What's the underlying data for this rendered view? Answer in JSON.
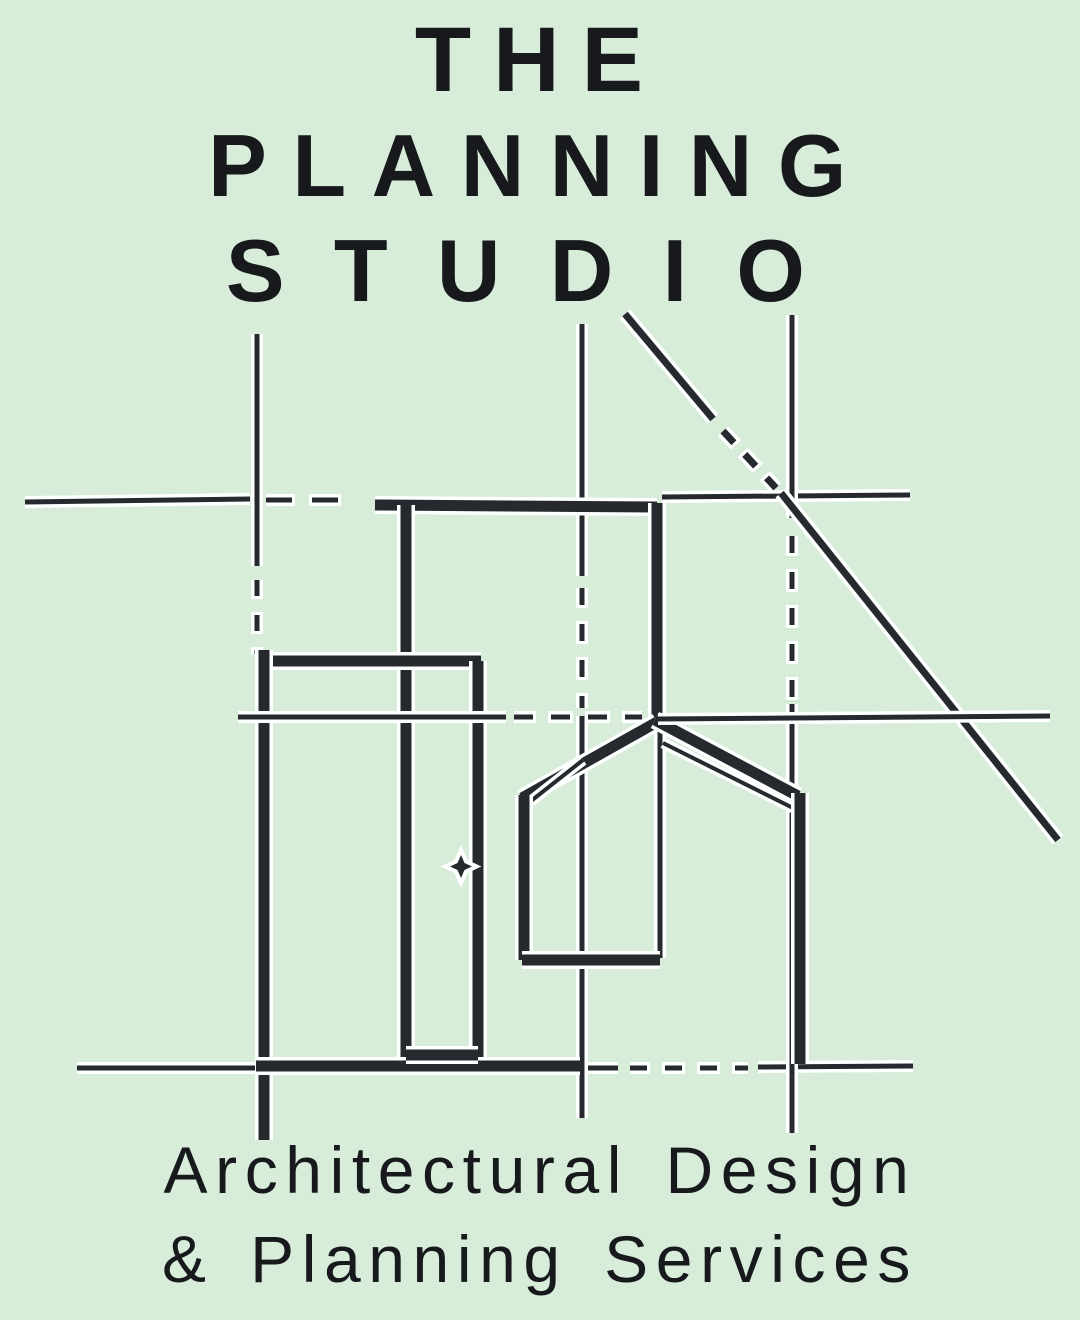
{
  "background_color": "#d7ecd9",
  "ink_color": "#17191c",
  "stroke_color": "#26292e",
  "halo_color": "#feffff",
  "title": {
    "line1": "THE",
    "line2": "PLANNING",
    "line3": "STUDIO"
  },
  "subtitle": {
    "line1": "Architectural Design",
    "line2": "& Planning Services"
  },
  "logo_drawing": {
    "description": "blueprint-style architectural sketch: construction lines, door frame, door with knob, two gabled building outlines, diagonal roof line",
    "strokes": [
      {
        "id": "construction-h-upper-left",
        "x1": 25,
        "y1": 502,
        "x2": 250,
        "y2": 499,
        "w": 5
      },
      {
        "id": "construction-h-upper-dashes",
        "x1": 266,
        "y1": 500,
        "x2": 354,
        "y2": 500,
        "w": 5,
        "dash": "26 20"
      },
      {
        "id": "construction-h-upper-right",
        "x1": 662,
        "y1": 497,
        "x2": 910,
        "y2": 495,
        "w": 5
      },
      {
        "id": "construction-h-lower-left",
        "x1": 77,
        "y1": 1068,
        "x2": 618,
        "y2": 1068,
        "w": 5
      },
      {
        "id": "construction-h-lower-dashes",
        "x1": 630,
        "y1": 1068,
        "x2": 748,
        "y2": 1068,
        "w": 5,
        "dash": "17 18"
      },
      {
        "id": "construction-h-lower-right",
        "x1": 758,
        "y1": 1067,
        "x2": 913,
        "y2": 1066,
        "w": 5
      },
      {
        "id": "construction-v1-top",
        "x1": 257,
        "y1": 334,
        "x2": 257,
        "y2": 566,
        "w": 5
      },
      {
        "id": "construction-v1-dashes",
        "x1": 257,
        "y1": 580,
        "x2": 257,
        "y2": 654,
        "w": 5,
        "dash": "16 19"
      },
      {
        "id": "construction-v2-top",
        "x1": 582,
        "y1": 324,
        "x2": 582,
        "y2": 576,
        "w": 5
      },
      {
        "id": "construction-v2-dashes",
        "x1": 582,
        "y1": 588,
        "x2": 582,
        "y2": 708,
        "w": 5,
        "dash": "17 19"
      },
      {
        "id": "construction-v2-bottom",
        "x1": 582,
        "y1": 716,
        "x2": 582,
        "y2": 1118,
        "w": 5
      },
      {
        "id": "construction-v3-top",
        "x1": 792,
        "y1": 315,
        "x2": 792,
        "y2": 518,
        "w": 5
      },
      {
        "id": "construction-v3-dashes",
        "x1": 792,
        "y1": 536,
        "x2": 792,
        "y2": 700,
        "w": 5,
        "dash": "17 19"
      },
      {
        "id": "construction-v3-bottom",
        "x1": 792,
        "y1": 704,
        "x2": 792,
        "y2": 1133,
        "w": 5
      },
      {
        "id": "roof-diagonal-top",
        "x1": 625,
        "y1": 314,
        "x2": 713,
        "y2": 419,
        "w": 7
      },
      {
        "id": "roof-diagonal-dashes",
        "x1": 723,
        "y1": 431,
        "x2": 776,
        "y2": 488,
        "w": 7,
        "dash": "16 16"
      },
      {
        "id": "roof-diagonal-bottom",
        "x1": 781,
        "y1": 493,
        "x2": 1058,
        "y2": 840,
        "w": 7
      },
      {
        "id": "frame-top",
        "x1": 375,
        "y1": 505,
        "x2": 657,
        "y2": 507,
        "w": 11
      },
      {
        "id": "frame-left",
        "x1": 406,
        "y1": 505,
        "x2": 406,
        "y2": 1060,
        "w": 11
      },
      {
        "id": "frame-right-upper",
        "x1": 657,
        "y1": 503,
        "x2": 657,
        "y2": 724,
        "w": 11
      },
      {
        "id": "frame-right-lower",
        "x1": 660,
        "y1": 724,
        "x2": 660,
        "y2": 958,
        "w": 5
      },
      {
        "id": "door-top",
        "x1": 258,
        "y1": 661,
        "x2": 481,
        "y2": 661,
        "w": 11
      },
      {
        "id": "door-left",
        "x1": 264,
        "y1": 650,
        "x2": 264,
        "y2": 1140,
        "w": 11
      },
      {
        "id": "door-right",
        "x1": 478,
        "y1": 661,
        "x2": 478,
        "y2": 1060,
        "w": 11
      },
      {
        "id": "door-bottom",
        "x1": 256,
        "y1": 1066,
        "x2": 580,
        "y2": 1066,
        "w": 11
      },
      {
        "id": "door-panel-bottom",
        "x1": 406,
        "y1": 1055,
        "x2": 478,
        "y2": 1055,
        "w": 11
      },
      {
        "id": "gable-left-roof",
        "x1": 657,
        "y1": 722,
        "x2": 522,
        "y2": 798,
        "w": 11
      },
      {
        "id": "gable-left-roof-echo",
        "x1": 583,
        "y1": 760,
        "x2": 531,
        "y2": 801,
        "w": 4
      },
      {
        "id": "gable-left-wall",
        "x1": 524,
        "y1": 795,
        "x2": 524,
        "y2": 960,
        "w": 11
      },
      {
        "id": "gable-left-bottom",
        "x1": 522,
        "y1": 960,
        "x2": 660,
        "y2": 960,
        "w": 11
      },
      {
        "id": "gable-right-roof",
        "x1": 655,
        "y1": 720,
        "x2": 798,
        "y2": 796,
        "w": 11
      },
      {
        "id": "gable-right-roof-echo",
        "x1": 663,
        "y1": 743,
        "x2": 793,
        "y2": 808,
        "w": 4
      },
      {
        "id": "gable-right-wall",
        "x1": 800,
        "y1": 793,
        "x2": 800,
        "y2": 1064,
        "w": 11
      },
      {
        "id": "construction-h-mid-left",
        "x1": 238,
        "y1": 717,
        "x2": 506,
        "y2": 717,
        "w": 5
      },
      {
        "id": "construction-h-mid-dashes",
        "x1": 514,
        "y1": 717,
        "x2": 642,
        "y2": 717,
        "w": 5,
        "dash": "19 18"
      },
      {
        "id": "construction-h-mid-right",
        "x1": 658,
        "y1": 719,
        "x2": 1050,
        "y2": 716,
        "w": 5
      }
    ],
    "door_knob": {
      "points": "461,855 464.5,863 472,866.5 464.5,870 461,878 457.5,870 450,866.5 457.5,863"
    }
  }
}
